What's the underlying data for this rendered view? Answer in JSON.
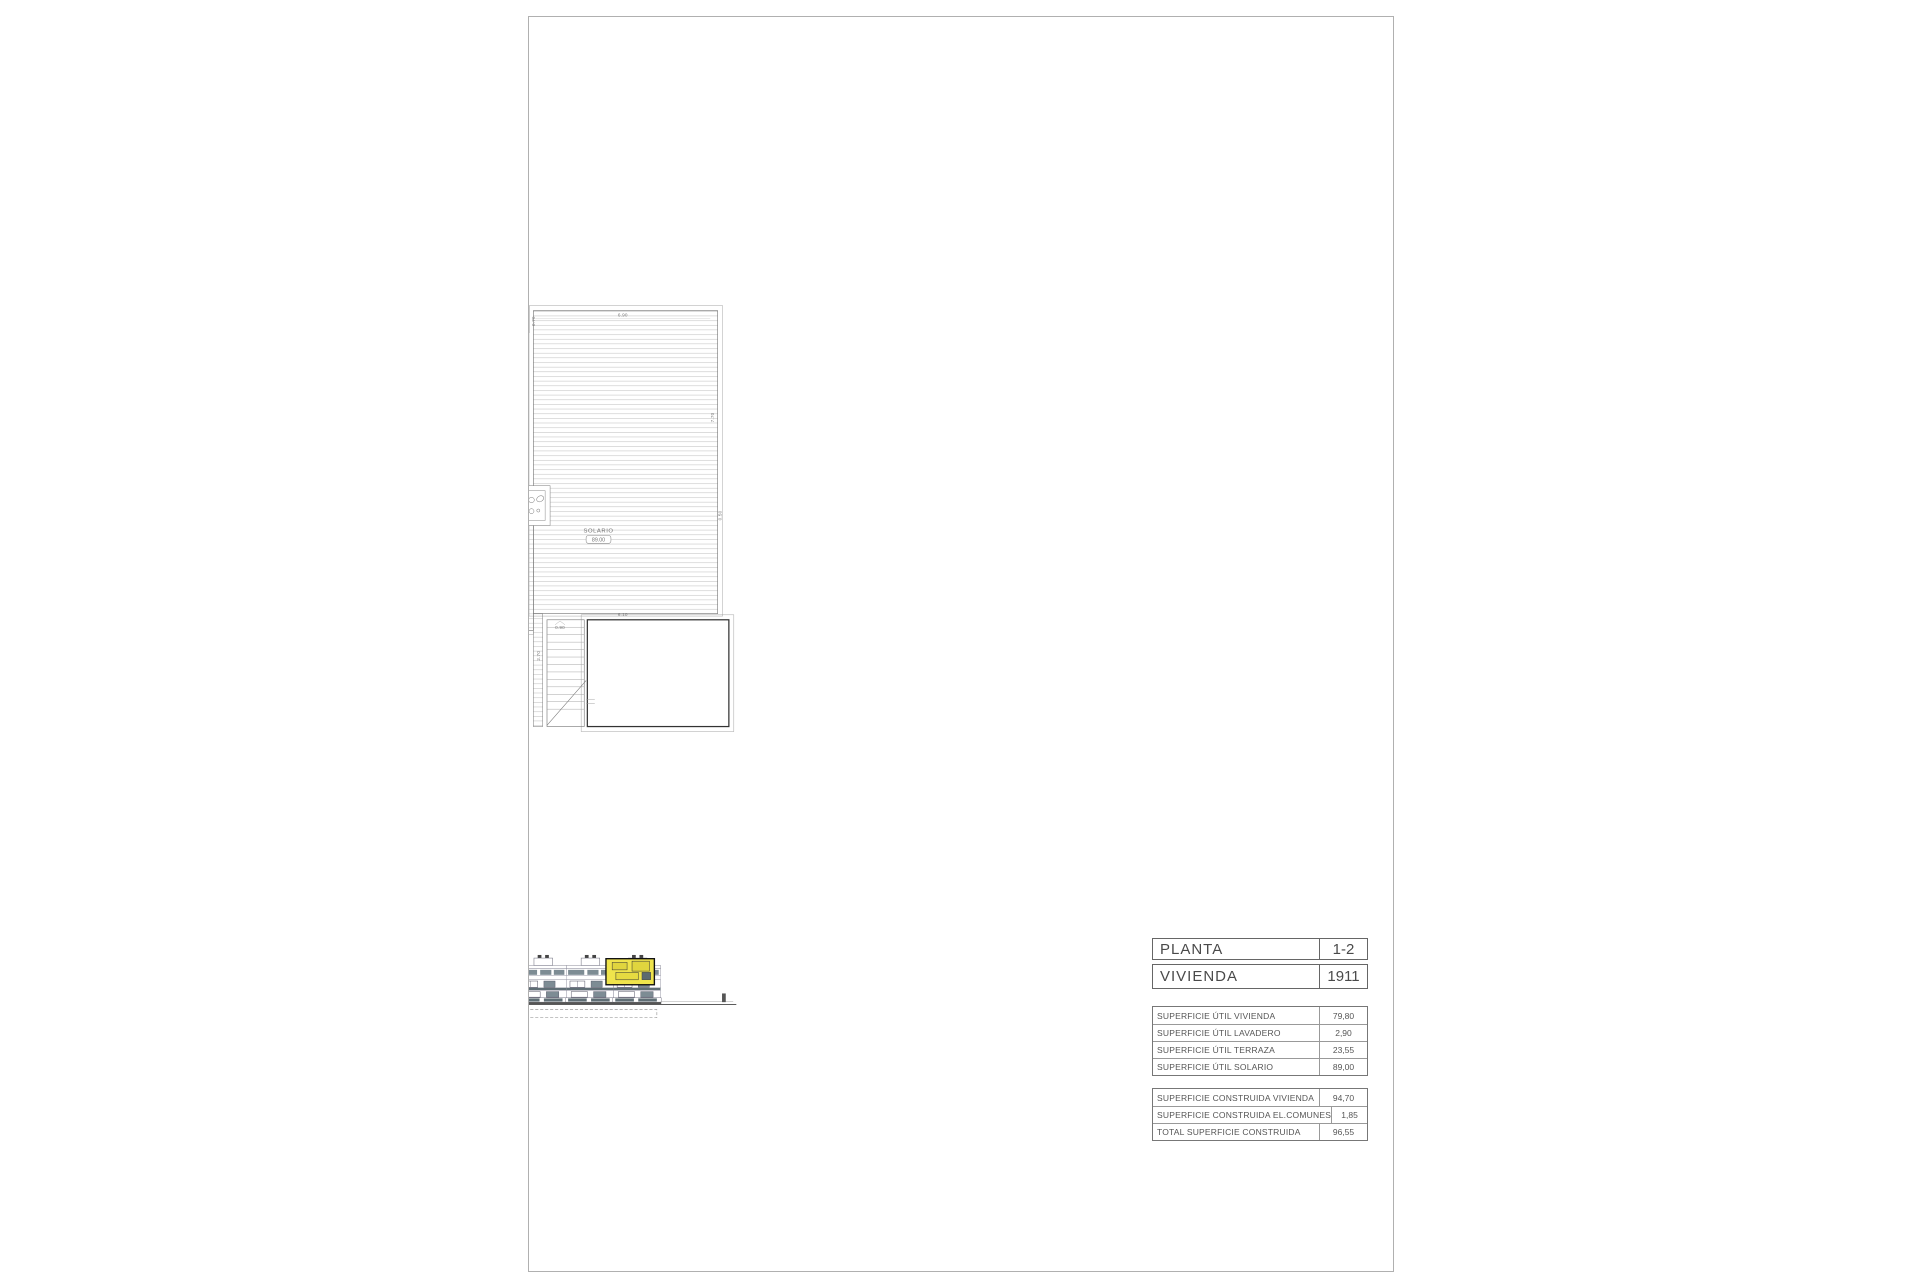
{
  "title_block": {
    "planta_label": "PLANTA",
    "planta_value": "1-2",
    "vivienda_label": "VIVIENDA",
    "vivienda_value": "1911",
    "util": [
      {
        "label": "SUPERFICIE ÚTIL VIVIENDA",
        "value": "79,80"
      },
      {
        "label": "SUPERFICIE ÚTIL LAVADERO",
        "value": "2,90"
      },
      {
        "label": "SUPERFICIE ÚTIL TERRAZA",
        "value": "23,55"
      },
      {
        "label": "SUPERFICIE ÚTIL SOLARIO",
        "value": "89,00"
      }
    ],
    "construida": [
      {
        "label": "SUPERFICIE CONSTRUIDA VIVIENDA",
        "value": "94,70"
      },
      {
        "label": "SUPERFICIE CONSTRUIDA EL.COMUNES",
        "value": "1,85"
      },
      {
        "label": "TOTAL SUPERFICIE CONSTRUIDA",
        "value": "96,55"
      }
    ]
  },
  "unit_tag": "1911",
  "rooms": {
    "dorm2": {
      "name": "DORM.2",
      "area": "10.60"
    },
    "dorm1": {
      "name": "DORM.1",
      "area": "13.65"
    },
    "aseo": {
      "name": "ASEO",
      "area": "3.90"
    },
    "bano": {
      "name": "BAÑO",
      "area": "4.30"
    },
    "paso": {
      "name": "PASO",
      "area": "3.50"
    },
    "estudio": {
      "name": "ESTUDIO",
      "area": "10.10"
    },
    "sck": {
      "name": "S.C.K",
      "area": "33.75"
    },
    "lav": {
      "name": "LAV.",
      "area": "2.90"
    },
    "terraza": {
      "name": "TERRAZA",
      "area": "23.55"
    },
    "solario": {
      "name": "SOLARIO",
      "area": "89.00"
    }
  },
  "dims": {
    "m_265": "2.65",
    "m_385t": "3.85",
    "m_425": "4.25",
    "m_475": "4.75",
    "m_310": "3.10",
    "m_100": "1.00",
    "m_060": "0.60",
    "m_150": "1.50",
    "m_110h": "1.10",
    "m_270a": "2.70",
    "m_280": "2.80",
    "m_385v": "3.85",
    "m_155": "1.55",
    "m_180": "1.80",
    "m_265e": "2.65",
    "m_360": "3.60",
    "m_385e": "3.85",
    "m_350s": "3.50",
    "m_580": "5.80",
    "m_195": "1.95",
    "m_110v": "1.10",
    "m_090s": "0.90",
    "m_570": "5.70",
    "m_610": "6.10",
    "m_140l": "1.40",
    "m_210l": "2.10",
    "m_270s": "2.70",
    "m_090t": "0.90",
    "m_675": "6.75",
    "m_400": "4.00",
    "s_070": "0.70",
    "s_690": "6.90",
    "s_770": "7.70",
    "s_050": "0.50",
    "s_140": "1.40",
    "s_750": "7.50",
    "s_610": "6.10",
    "s_090": "0.90",
    "s_270": "2.70",
    "s_210": "2.10"
  },
  "scalebar": {
    "label": "ESCALA :",
    "north": "N",
    "ticks": [
      "0",
      "1",
      "2",
      "3",
      "4",
      "5"
    ]
  },
  "colors": {
    "wall": "#5c5c5c",
    "furniture": "#c9c9c9",
    "accent_yellow": "#f2e84b",
    "slate": "#7d8c94",
    "text": "#777777"
  }
}
